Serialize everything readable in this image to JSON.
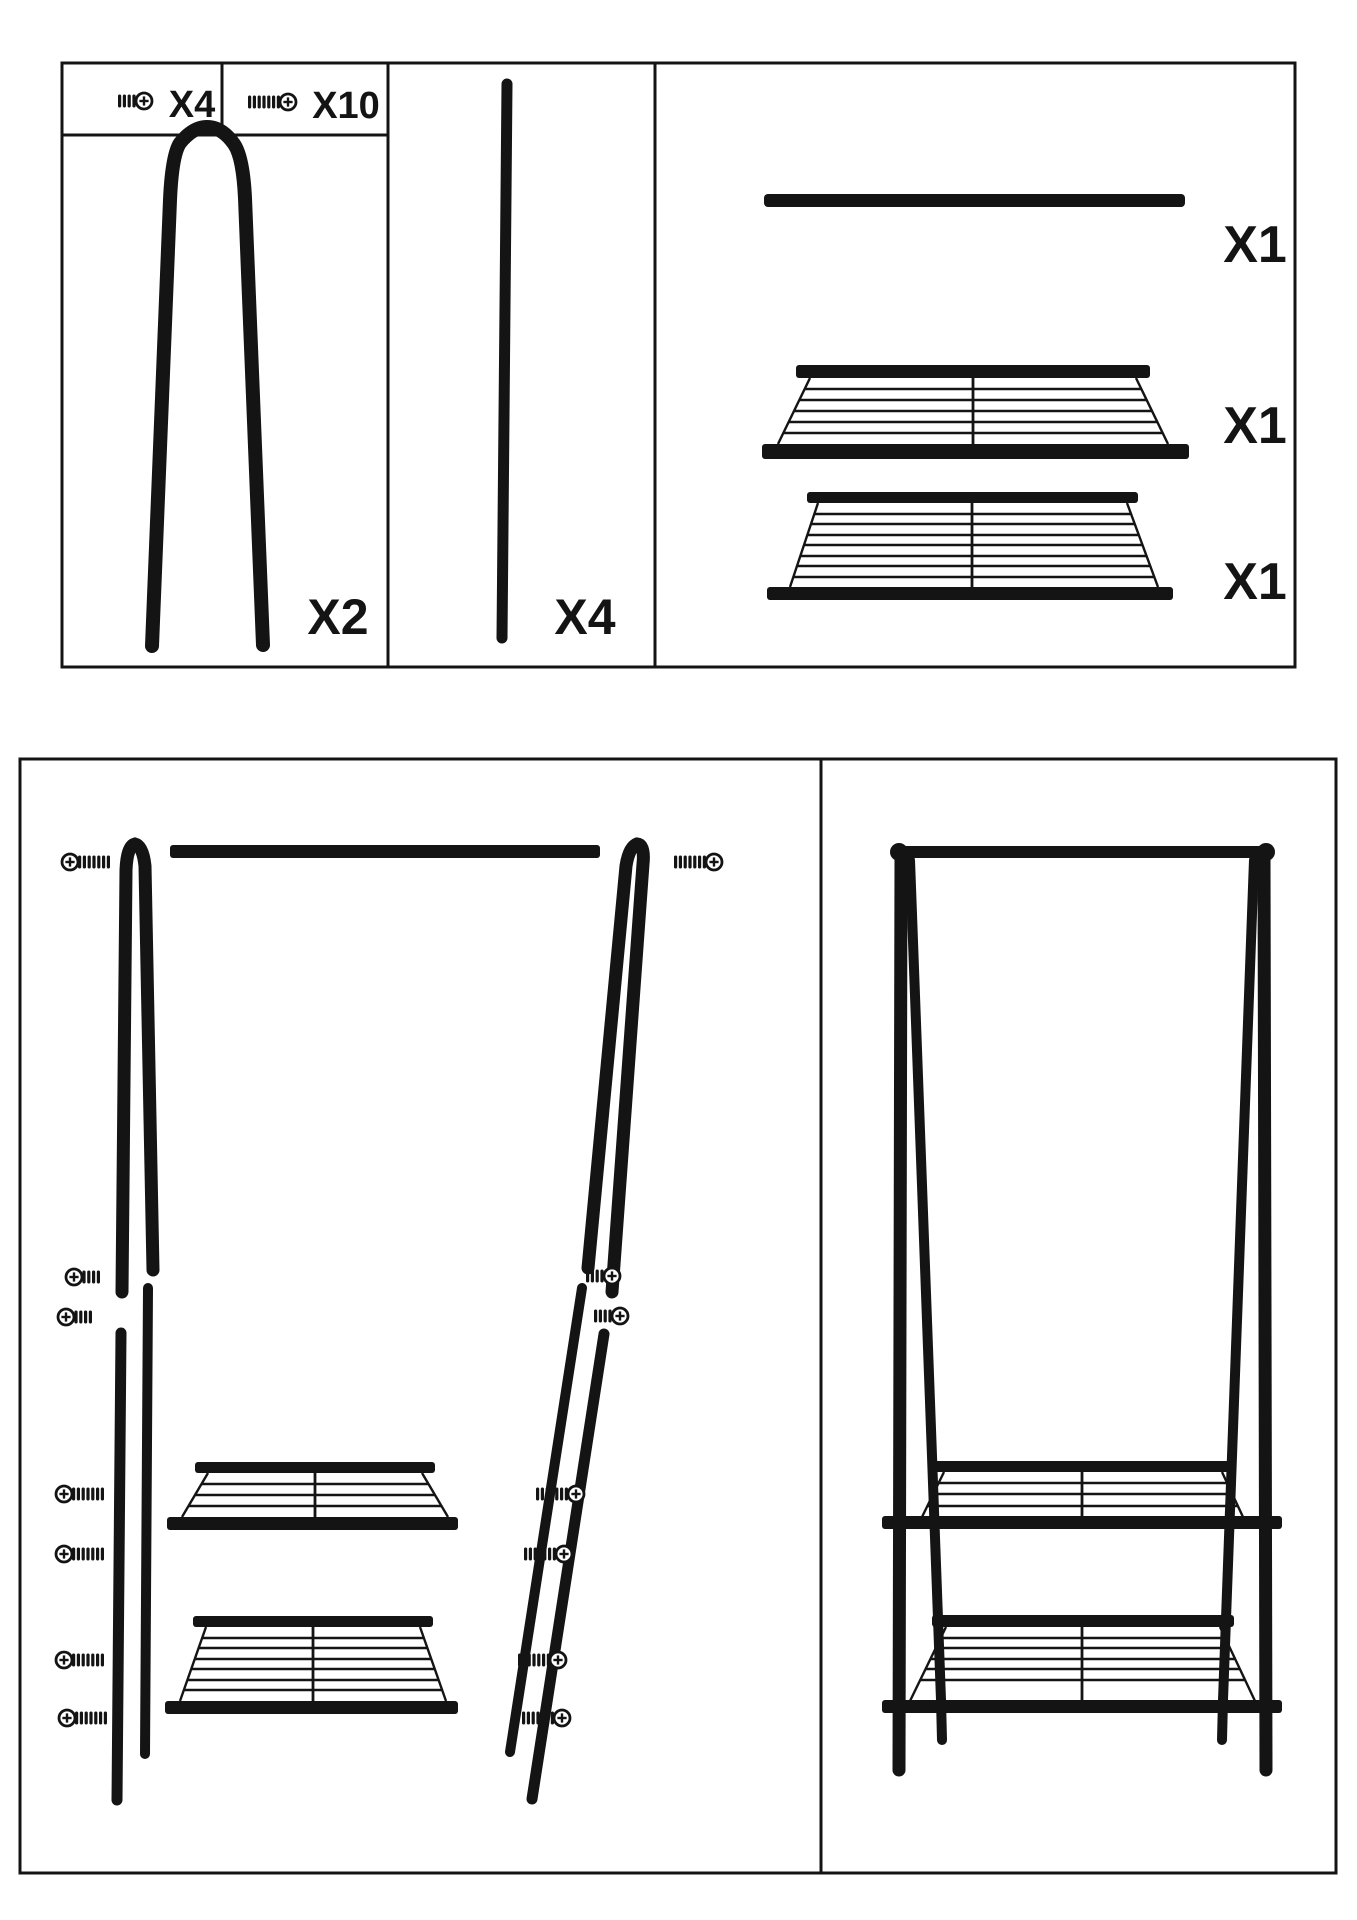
{
  "colors": {
    "ink": "#141414",
    "paper": "#ffffff"
  },
  "parts_list": {
    "short_screw_qty": "X4",
    "long_screw_qty": "X10",
    "a_frame_qty": "X2",
    "pole_qty": "X4",
    "hanging_rail_qty": "X1",
    "middle_shelf_qty": "X1",
    "bottom_shelf_qty": "X1"
  }
}
